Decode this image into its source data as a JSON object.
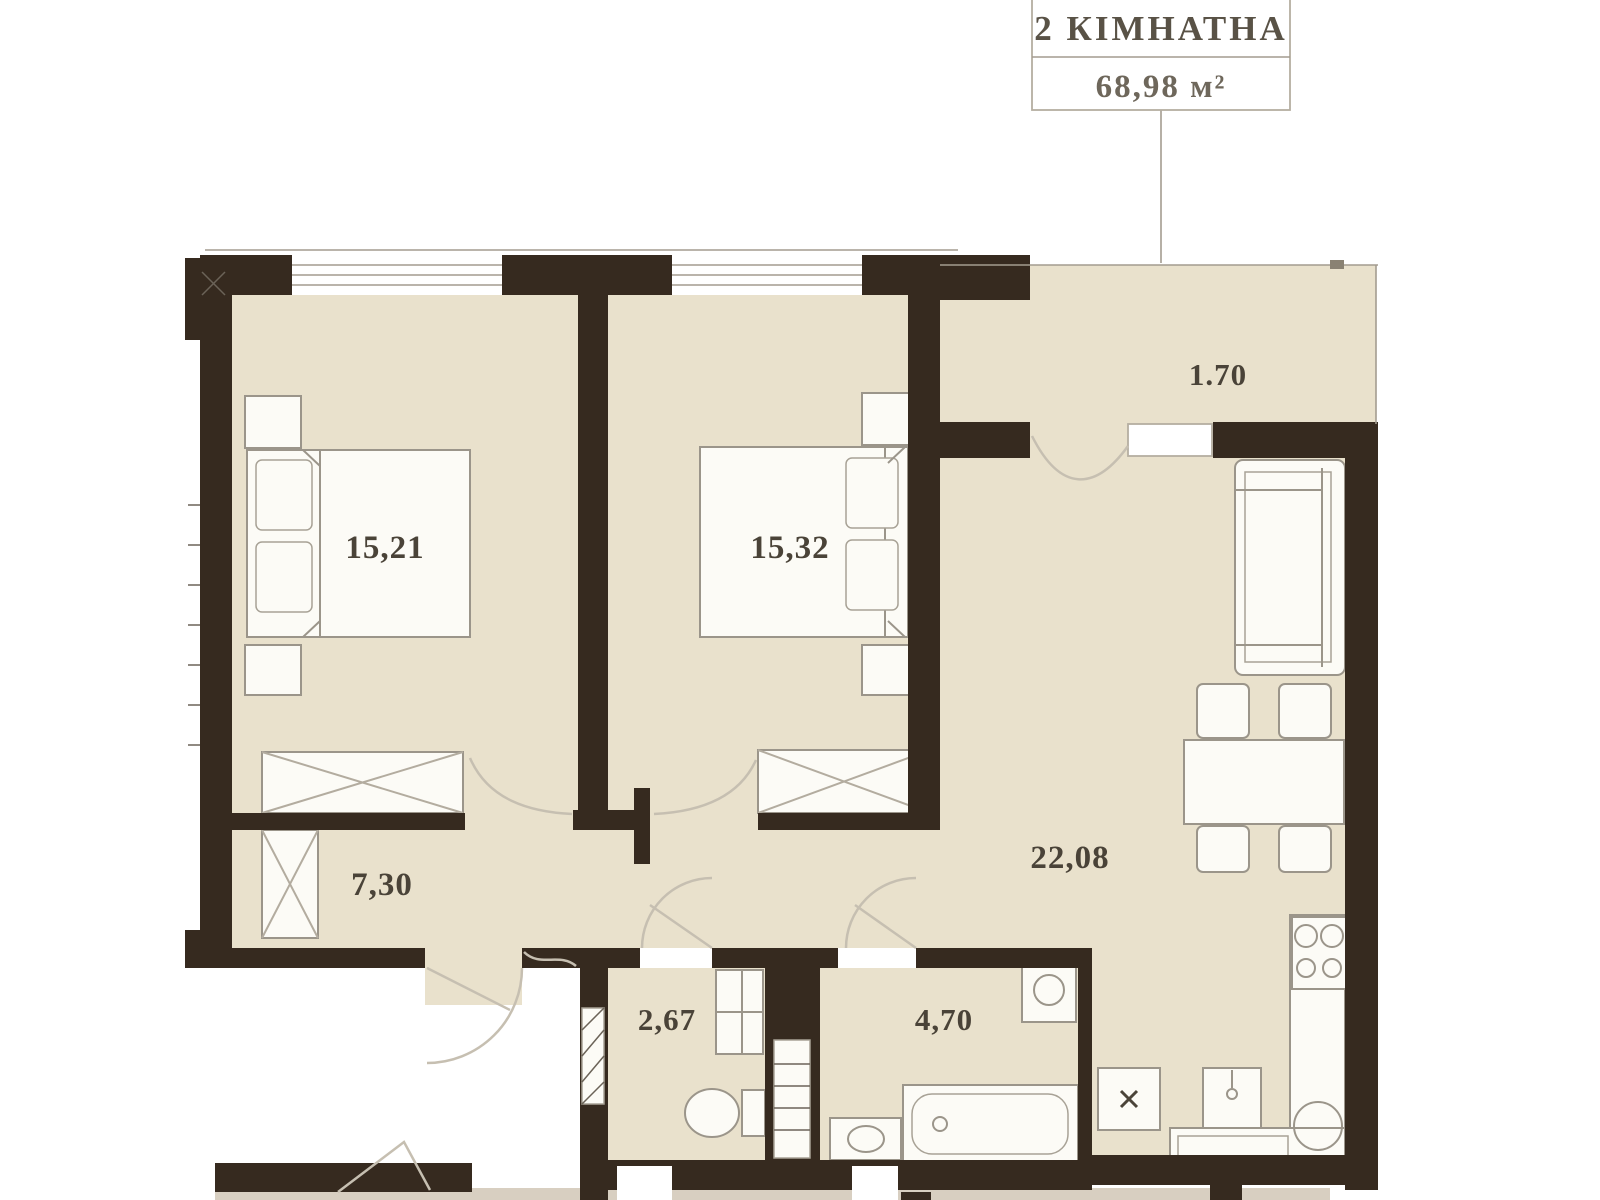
{
  "title_box": {
    "type_label": "2 КІМНАТНА",
    "area_label": "68,98 м²"
  },
  "rooms": [
    {
      "id": "bedroom-1",
      "name": "bedroom 1",
      "area": "15,21"
    },
    {
      "id": "bedroom-2",
      "name": "bedroom 2",
      "area": "15,32"
    },
    {
      "id": "living-kitchen",
      "name": "living room kitchen",
      "area": "22,08"
    },
    {
      "id": "hallway",
      "name": "hallway",
      "area": "7,30"
    },
    {
      "id": "wc",
      "name": "wc",
      "area": "2,67"
    },
    {
      "id": "bathroom",
      "name": "bathroom",
      "area": "4,70"
    },
    {
      "id": "entrance-hall",
      "name": "entrance hall",
      "area": "1.70"
    }
  ],
  "colors": {
    "wall": "#362a1f",
    "floor": "#e9e1cc",
    "corridor": "#d8cfc1",
    "furniture_line": "#9b958a",
    "label_text": "#4a4338"
  }
}
